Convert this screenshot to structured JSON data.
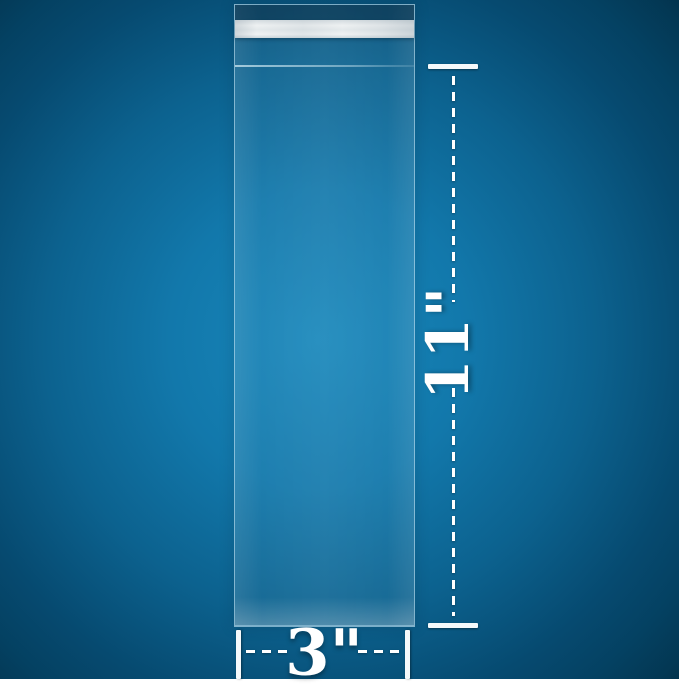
{
  "product_image": {
    "subject": "clear resealable cellophane bag with self-adhesive flap",
    "dimensions": {
      "height_label": "11\"",
      "width_label": "3\""
    },
    "colors": {
      "background_center": "#1887bb",
      "background_edge": "#033a57",
      "dimension_marks": "#ffffff",
      "adhesive_strip": "#e8ecee",
      "bag_edge": "#bfe0f0"
    }
  }
}
